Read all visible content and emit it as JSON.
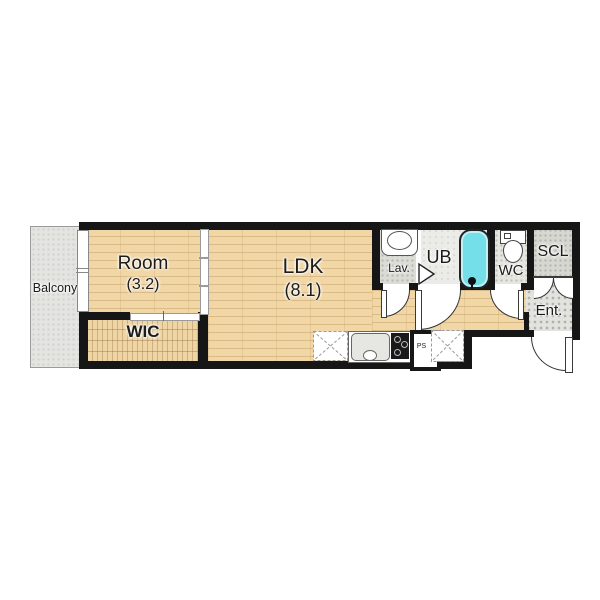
{
  "rooms": {
    "balcony": {
      "label": "Balcony"
    },
    "room": {
      "label": "Room",
      "size": "(3.2)"
    },
    "wic": {
      "label": "WIC"
    },
    "ldk": {
      "label": "LDK",
      "size": "(8.1)"
    },
    "lav": {
      "label": "Lav."
    },
    "ub": {
      "label": "UB"
    },
    "wc": {
      "label": "WC"
    },
    "scl": {
      "label": "SCL"
    },
    "ent": {
      "label": "Ent."
    },
    "ps": {
      "label": "PS"
    }
  },
  "fixtures": [
    "bathtub",
    "washbasin",
    "toilet",
    "kitchen-sink",
    "gas-stove",
    "refrigerator-space",
    "appliance-space",
    "pipe-shaft",
    "sliding-partition",
    "balcony-window",
    "entrance-door"
  ],
  "colors": {
    "wall": "#161616",
    "wood_floor": "#f1d6a6",
    "bathtub": "#74dfe8",
    "balcony": "#e4e4e1",
    "entrance_tile": "#e2e2de"
  }
}
